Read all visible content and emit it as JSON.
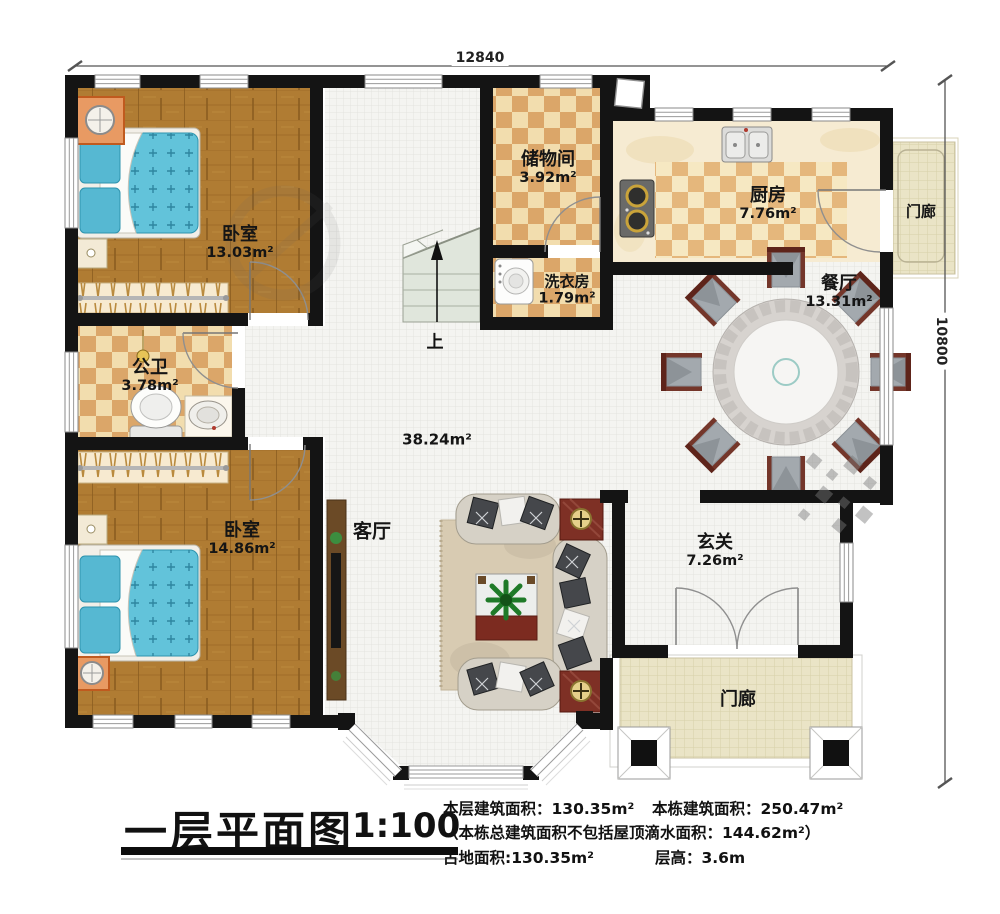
{
  "dimensions": {
    "width_mm": "12840",
    "height_mm": "10800"
  },
  "rooms": {
    "bedroom1": {
      "name": "卧室",
      "area": "13.03m²"
    },
    "storage": {
      "name": "储物间",
      "area": "3.92m²"
    },
    "kitchen": {
      "name": "厨房",
      "area": "7.76m²"
    },
    "laundry": {
      "name": "洗衣房",
      "area": "1.79m²"
    },
    "dining": {
      "name": "餐厅",
      "area": "13.31m²"
    },
    "bathroom": {
      "name": "公卫",
      "area": "3.78m²"
    },
    "bedroom2": {
      "name": "卧室",
      "area": "14.86m²"
    },
    "foyer": {
      "name": "玄关",
      "area": "7.26m²"
    },
    "living": {
      "name": "客厅",
      "area": "38.24m²"
    },
    "porch_right": {
      "name": "门廊"
    },
    "porch_bottom": {
      "name": "门廊"
    }
  },
  "stairs": {
    "direction_label": "上"
  },
  "footer": {
    "plan_title": "一层平面图",
    "scale": "1:100",
    "floor_area_label": "本层建筑面积：130.35m²",
    "building_area_label": "本栋建筑面积：250.47m²",
    "note": "（本栋总建筑面积不包括屋顶滴水面积：144.62m²）",
    "land_area_label": "占地面积:130.35m²",
    "floor_height_label": "层高：3.6m"
  }
}
